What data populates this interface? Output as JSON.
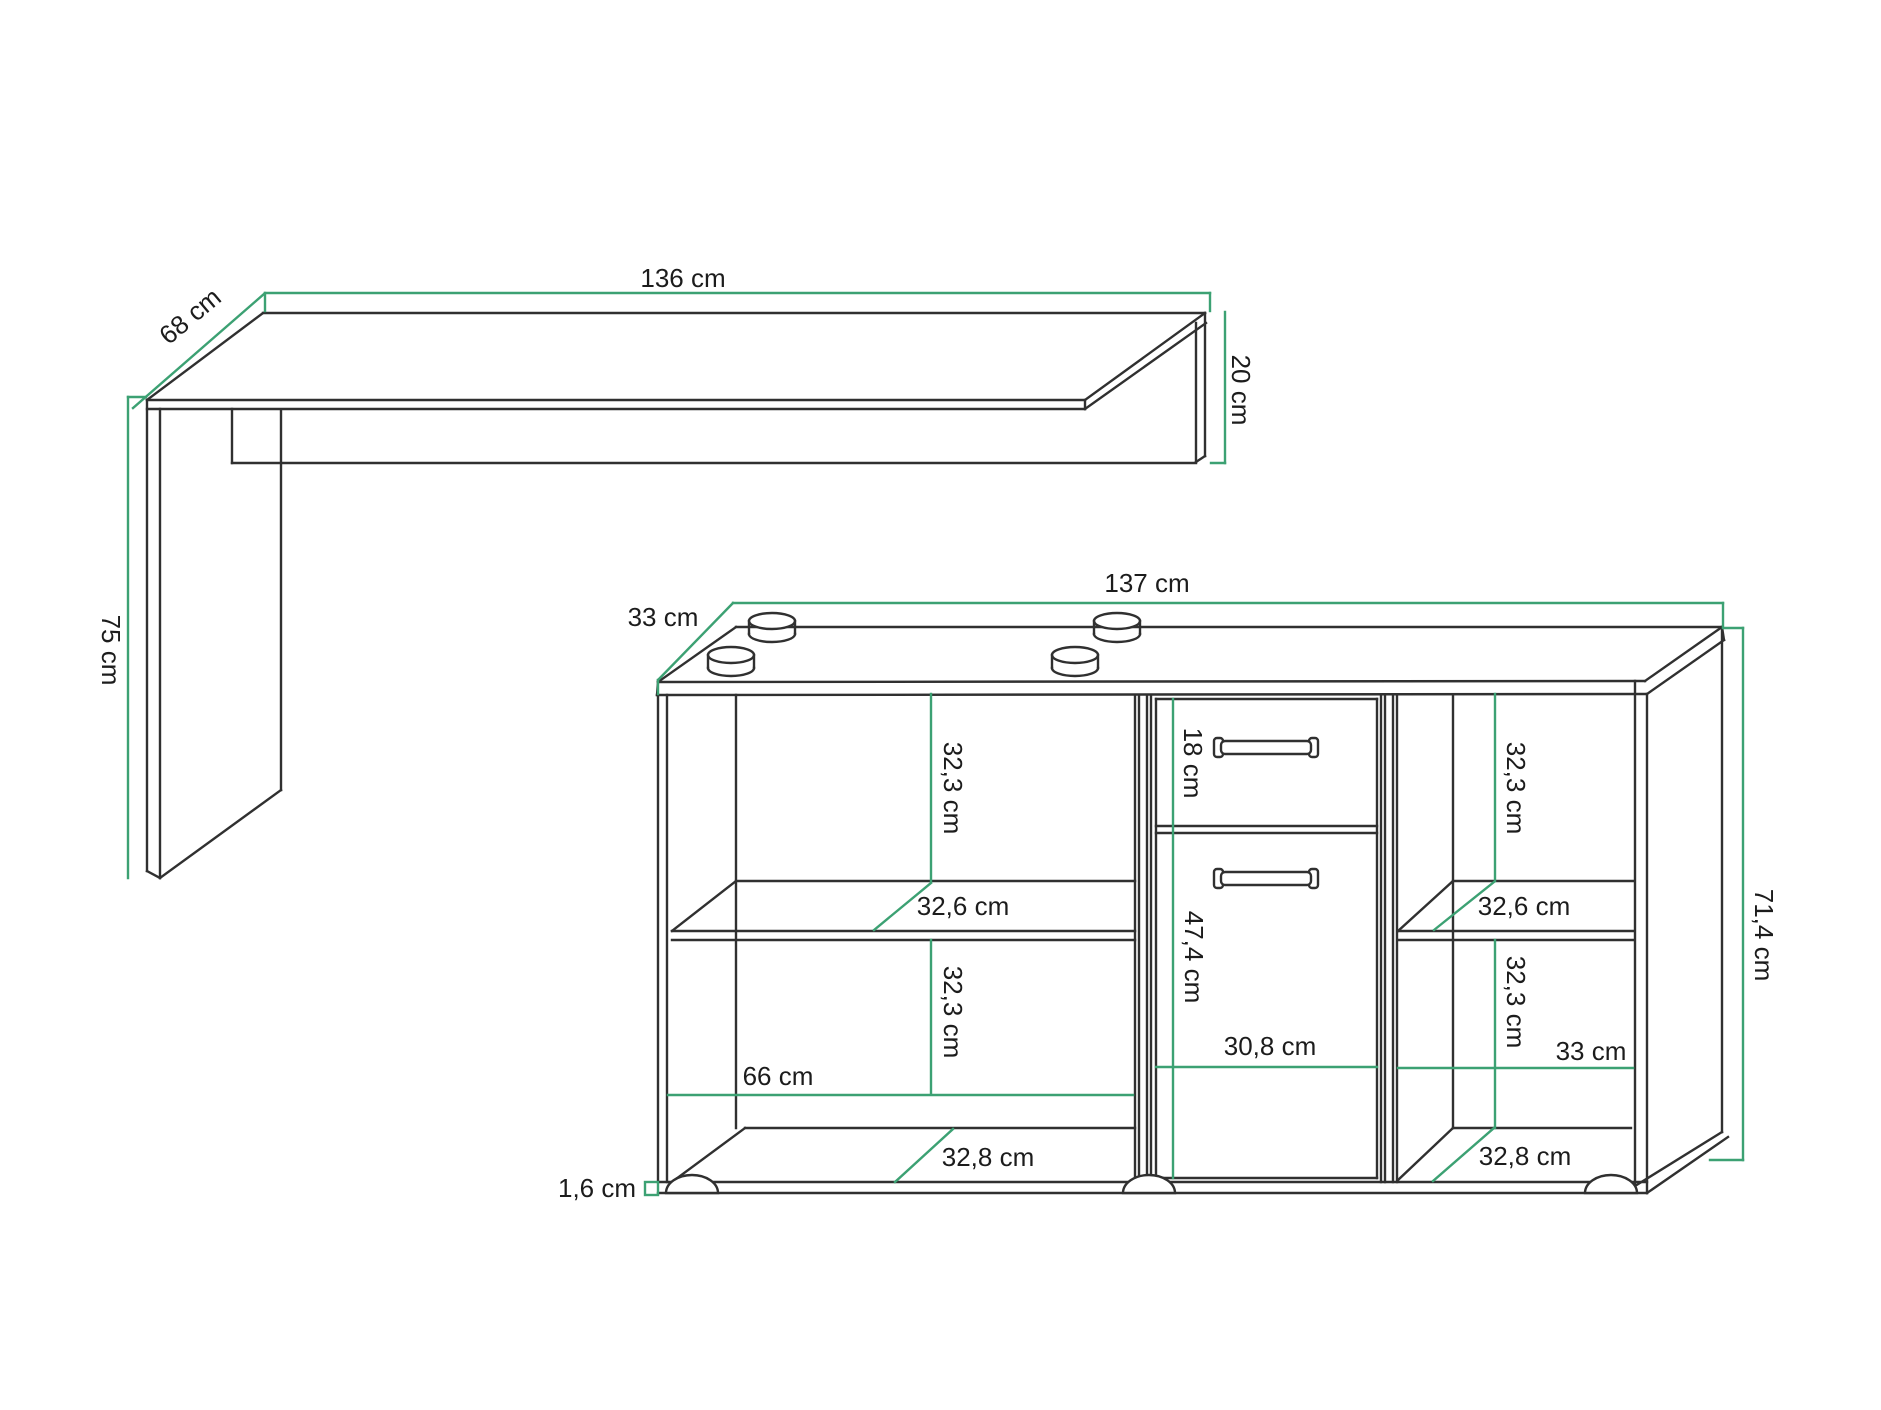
{
  "colors": {
    "line": "#303030",
    "dimension": "#3ca173",
    "text": "#1c1c1c",
    "background": "#ffffff"
  },
  "diagram": {
    "desk": {
      "width": "136 cm",
      "depth": "68 cm",
      "height": "75 cm",
      "front_panel_height": "20 cm"
    },
    "cabinet": {
      "width": "137 cm",
      "depth": "33 cm",
      "height": "71,4 cm",
      "bottom_thickness": "1,6 cm",
      "left_section": {
        "upper_compartment_height": "32,3 cm",
        "shelf_depth": "32,6 cm",
        "lower_compartment_height": "32,3 cm",
        "inner_width": "66 cm",
        "bottom_depth": "32,8 cm"
      },
      "middle_section": {
        "drawer_height": "18 cm",
        "door_height": "47,4 cm",
        "inner_width": "30,8 cm"
      },
      "right_section": {
        "upper_compartment_height": "32,3 cm",
        "shelf_depth": "32,6 cm",
        "lower_compartment_height": "32,3 cm",
        "inner_width": "33 cm",
        "bottom_depth": "32,8 cm"
      }
    }
  }
}
